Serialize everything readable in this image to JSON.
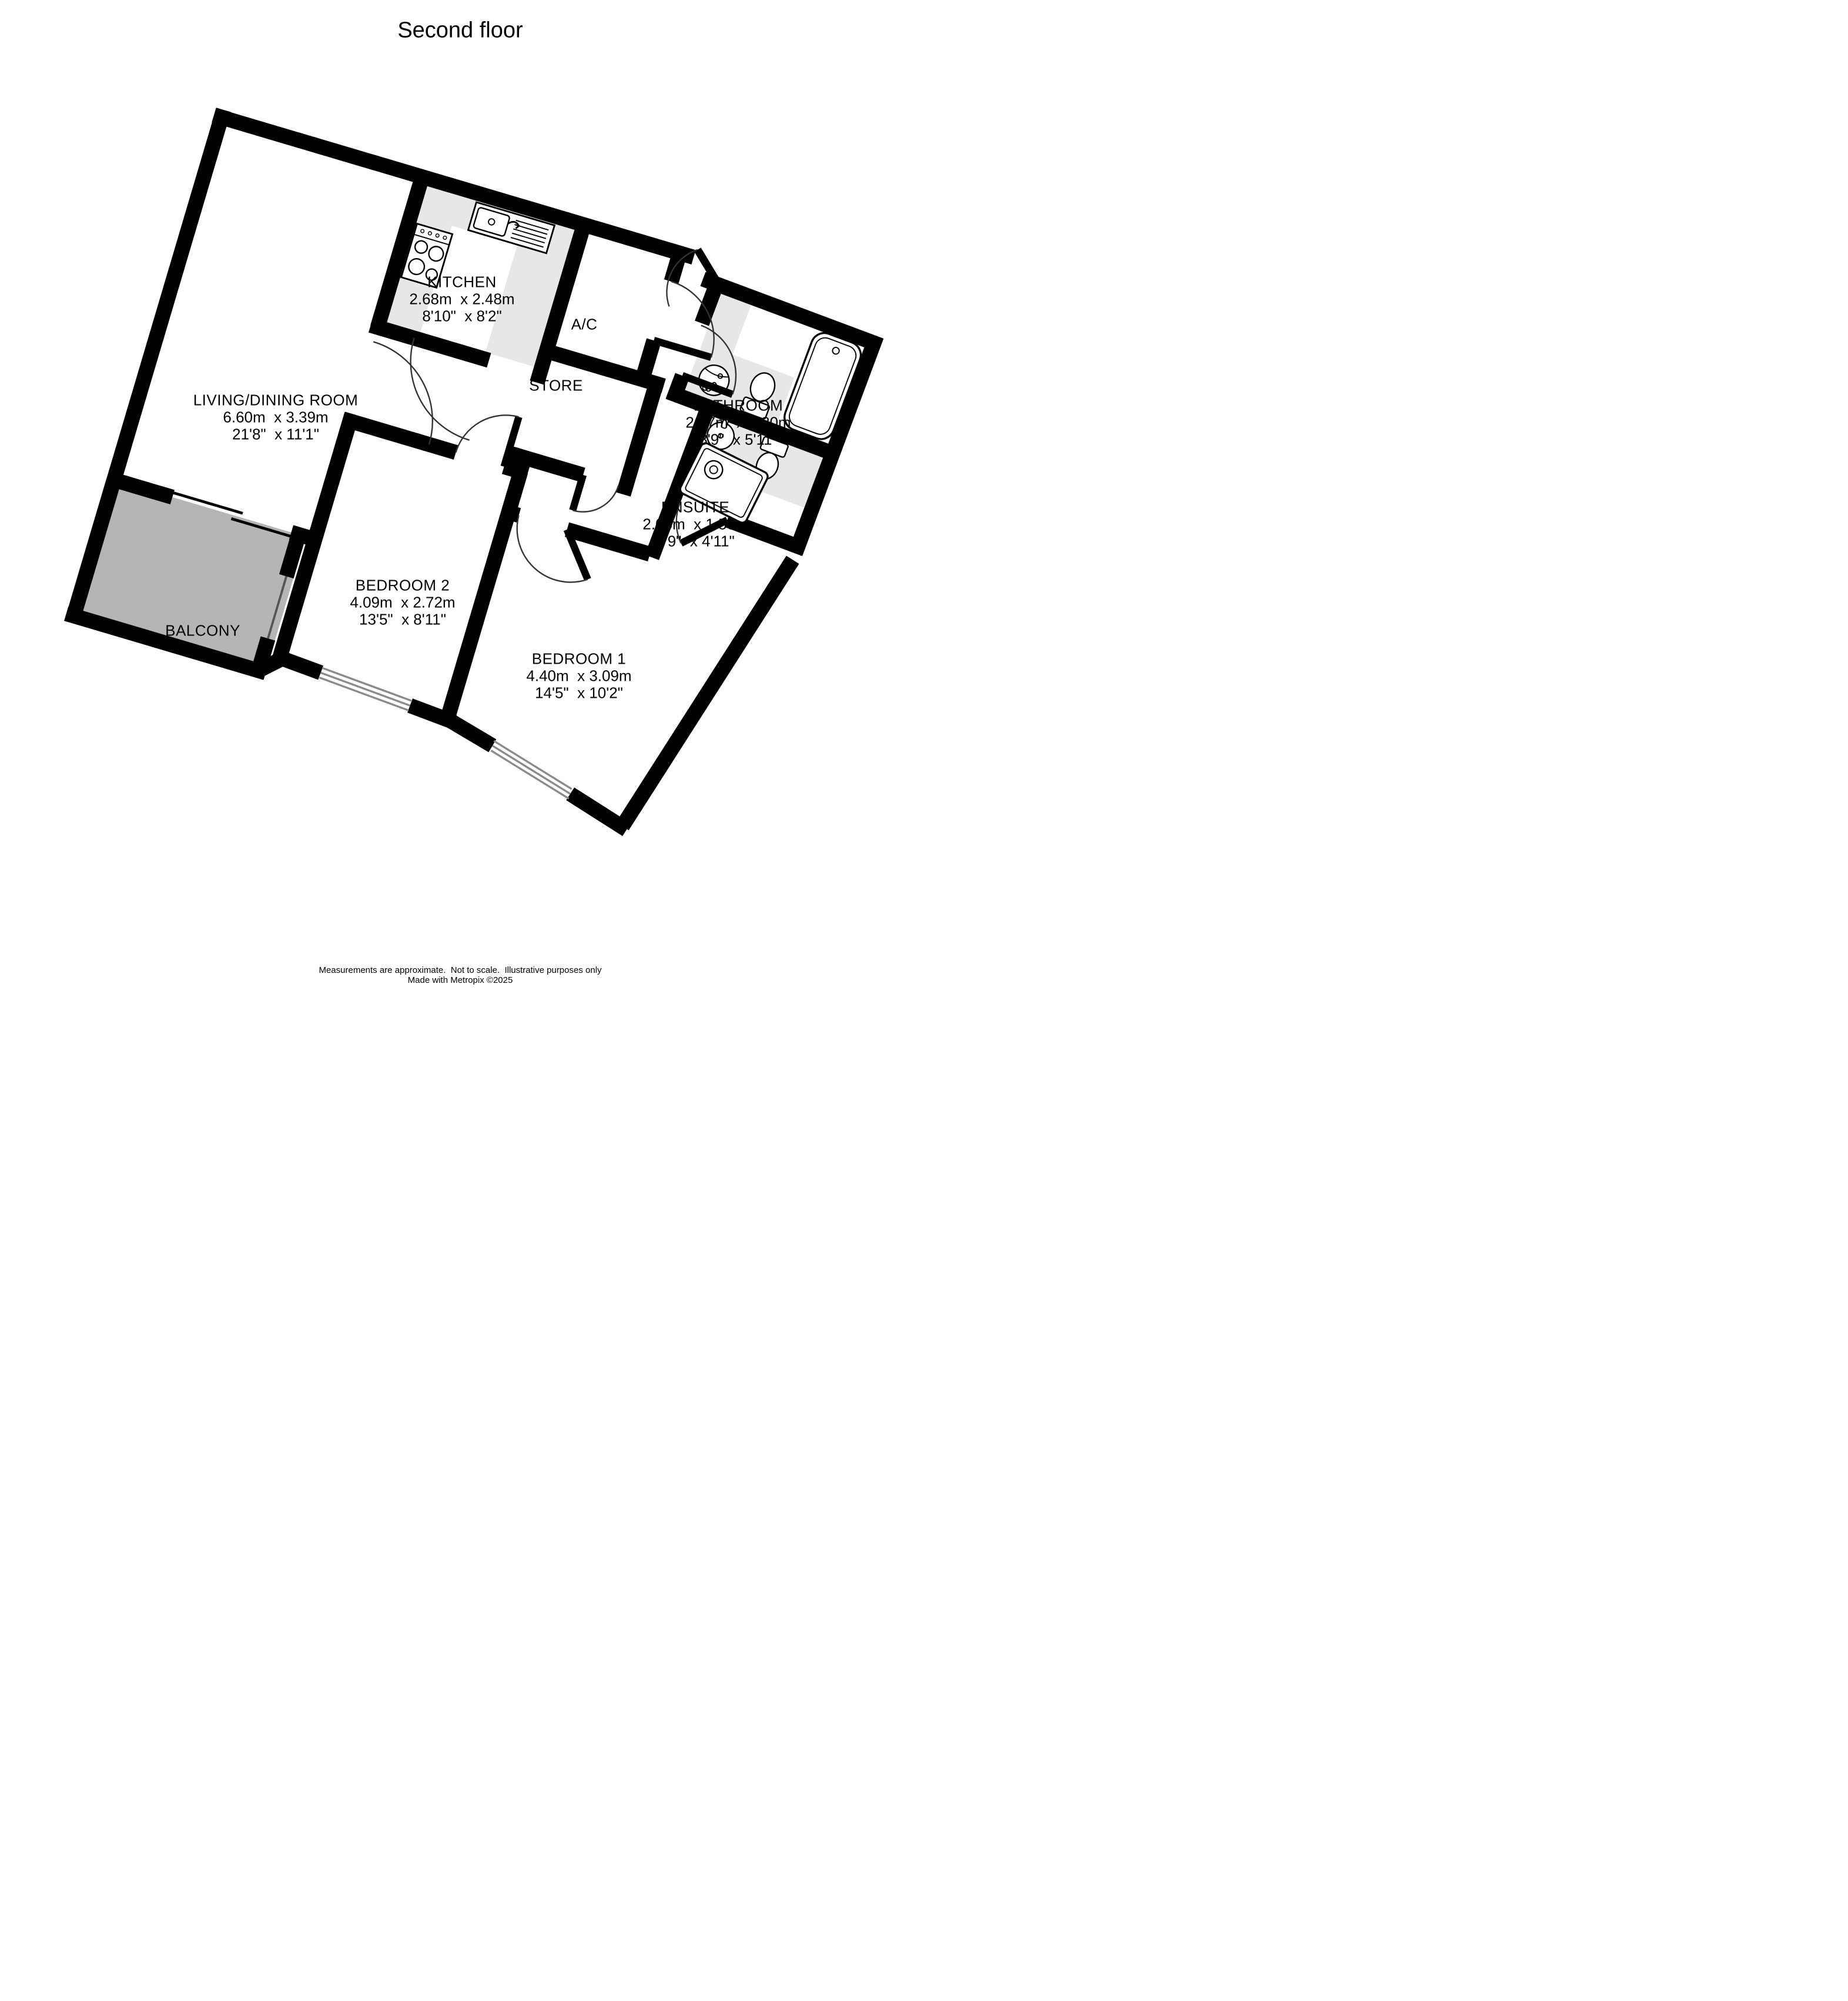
{
  "title": "Second floor",
  "rooms": [
    {
      "id": "living",
      "name": "LIVING/DINING ROOM",
      "metric": "6.60m  x 3.39m",
      "imperial": "21'8\"  x 11'1\""
    },
    {
      "id": "kitchen",
      "name": "KITCHEN",
      "metric": "2.68m  x 2.48m",
      "imperial": "8'10\"  x 8'2\""
    },
    {
      "id": "ac",
      "name": "A/C"
    },
    {
      "id": "store",
      "name": "STORE"
    },
    {
      "id": "bathroom",
      "name": "BATHROOM",
      "metric": "2.67m  x 1.80m",
      "imperial": "8'9\"  x 5'11\""
    },
    {
      "id": "ensuite",
      "name": "ENSUITE",
      "metric": "2.06m  x 1.50m",
      "imperial": "6'9\"  x 4'11\""
    },
    {
      "id": "bedroom2",
      "name": "BEDROOM 2",
      "metric": "4.09m  x 2.72m",
      "imperial": "13'5\"  x 8'11\""
    },
    {
      "id": "bedroom1",
      "name": "BEDROOM 1",
      "metric": "4.40m  x 3.09m",
      "imperial": "14'5\"  x 10'2\""
    },
    {
      "id": "balcony",
      "name": "BALCONY"
    }
  ],
  "footer": {
    "line1": "Measurements are approximate.  Not to scale.  Illustrative purposes only",
    "line2": "Made with Metropix ©2025"
  },
  "colors": {
    "wall": "#000000",
    "floor": "#ffffff",
    "balcony_fill": "#b5b5b5",
    "counter_fill": "#e7e7e7",
    "window_line": "#8a8a8a"
  }
}
